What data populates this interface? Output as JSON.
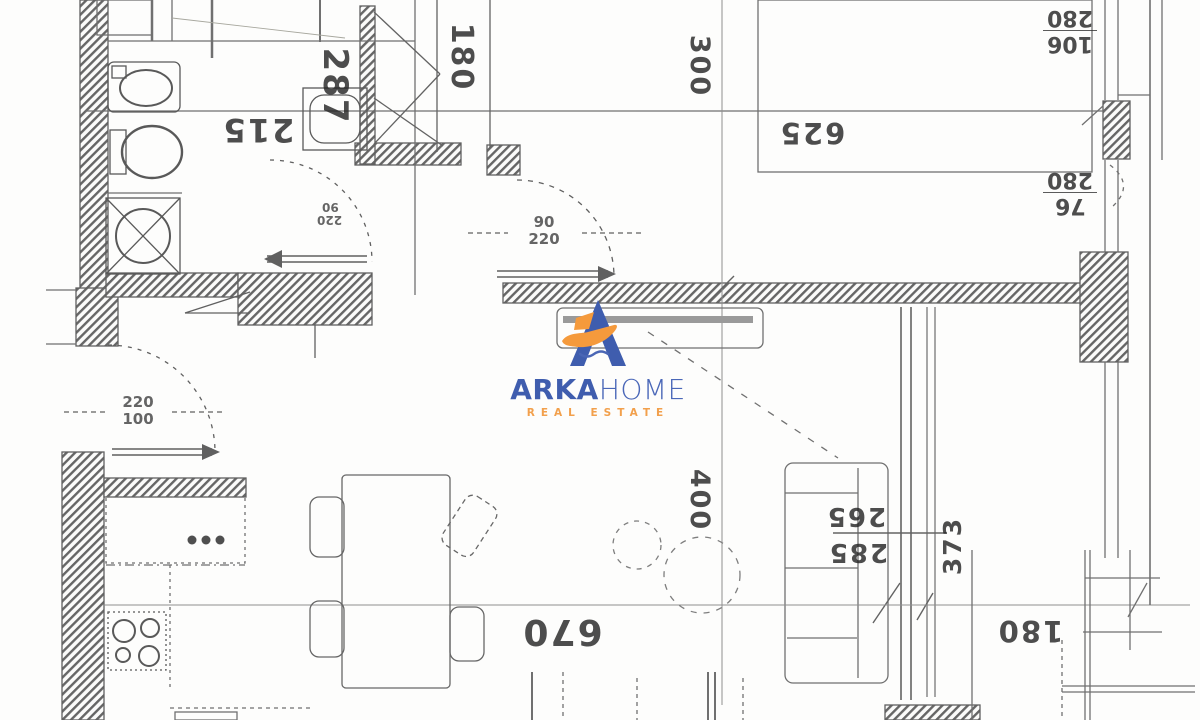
{
  "document": {
    "type": "apartment floor plan (scanned)"
  },
  "watermark": {
    "brand_primary": "ARKA",
    "brand_secondary": "HOME",
    "tagline": "REAL ESTATE",
    "blue": "#3f5dae",
    "blue_light": "#4a67b8",
    "orange": "#f49a3d"
  },
  "dimensions": {
    "bath_width": "287",
    "hall_width": "215",
    "niche_width": "180",
    "bedroom_width": "300",
    "bedroom_length": "625",
    "window1_w": "280",
    "window1_h": "106",
    "window2_w": "280",
    "window2_h": "76",
    "door_bedroom_w": "90",
    "door_bedroom_h": "220",
    "door_wc_w": "90",
    "door_wc_h": "220",
    "door_entry_w": "220",
    "door_entry_h": "100",
    "living_depth": "400",
    "sofa_a": "265",
    "sofa_b": "285",
    "right_wall": "373",
    "living_width": "670",
    "terrace_width": "180"
  },
  "fixtures": [
    "washbasin",
    "toilet",
    "washing-machine",
    "wc-basin",
    "cooktop",
    "kitchen-counter",
    "dining-table",
    "chairs",
    "sofa",
    "bed",
    "tv-stand"
  ]
}
